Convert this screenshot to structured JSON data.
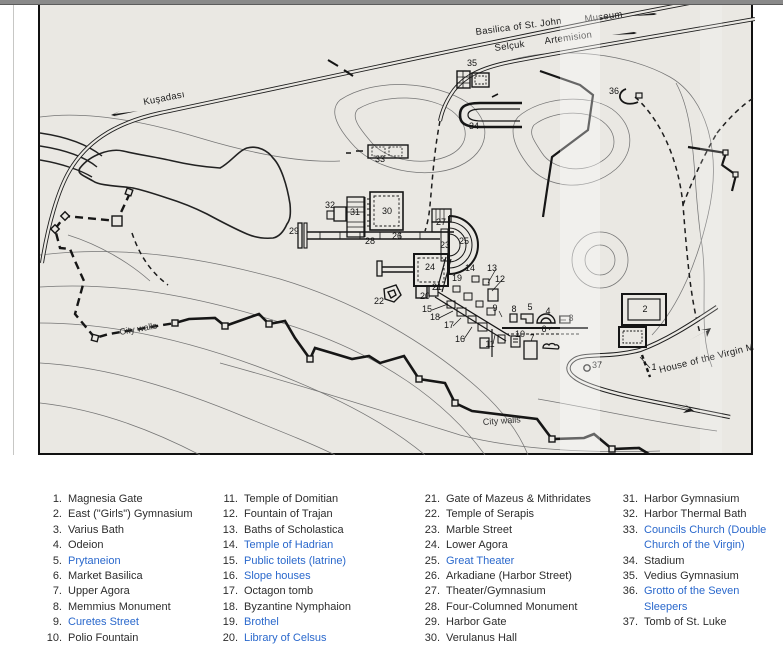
{
  "map": {
    "labels": {
      "basilica": "Basilica of St. John",
      "museum": "Museum",
      "selcuk": "Selçuk",
      "artemision": "Artemision",
      "kusadasi": "Kuşadası",
      "city_walls_west": "City walls",
      "city_walls_south": "City walls",
      "virgin_road": "House of the Virgin M"
    },
    "markers": [
      {
        "n": "1",
        "x": 614,
        "y": 365
      },
      {
        "n": "2",
        "x": 605,
        "y": 307
      },
      {
        "n": "3",
        "x": 531,
        "y": 316
      },
      {
        "n": "4",
        "x": 508,
        "y": 309
      },
      {
        "n": "5",
        "x": 490,
        "y": 305
      },
      {
        "n": "6",
        "x": 504,
        "y": 327
      },
      {
        "n": "7",
        "x": 492,
        "y": 336
      },
      {
        "n": "8",
        "x": 474,
        "y": 307
      },
      {
        "n": "9",
        "x": 455,
        "y": 306
      },
      {
        "n": "10",
        "x": 480,
        "y": 332
      },
      {
        "n": "11",
        "x": 450,
        "y": 342
      },
      {
        "n": "12",
        "x": 460,
        "y": 277
      },
      {
        "n": "13",
        "x": 452,
        "y": 266
      },
      {
        "n": "14",
        "x": 430,
        "y": 266
      },
      {
        "n": "15",
        "x": 387,
        "y": 307
      },
      {
        "n": "16",
        "x": 420,
        "y": 337
      },
      {
        "n": "17",
        "x": 409,
        "y": 323
      },
      {
        "n": "18",
        "x": 395,
        "y": 315
      },
      {
        "n": "19",
        "x": 417,
        "y": 276
      },
      {
        "n": "20",
        "x": 385,
        "y": 294
      },
      {
        "n": "21",
        "x": 397,
        "y": 285
      },
      {
        "n": "22",
        "x": 339,
        "y": 299
      },
      {
        "n": "23",
        "x": 405,
        "y": 243
      },
      {
        "n": "24",
        "x": 390,
        "y": 265
      },
      {
        "n": "25",
        "x": 424,
        "y": 239
      },
      {
        "n": "26",
        "x": 357,
        "y": 234
      },
      {
        "n": "27",
        "x": 401,
        "y": 220
      },
      {
        "n": "28",
        "x": 330,
        "y": 239
      },
      {
        "n": "29",
        "x": 254,
        "y": 229
      },
      {
        "n": "30",
        "x": 347,
        "y": 209
      },
      {
        "n": "31",
        "x": 315,
        "y": 210
      },
      {
        "n": "32",
        "x": 290,
        "y": 203
      },
      {
        "n": "33",
        "x": 340,
        "y": 157
      },
      {
        "n": "34",
        "x": 434,
        "y": 124
      },
      {
        "n": "35",
        "x": 432,
        "y": 61
      },
      {
        "n": "36",
        "x": 574,
        "y": 89
      },
      {
        "n": "37",
        "x": 557,
        "y": 363
      }
    ]
  },
  "legend": {
    "columns": [
      {
        "items": [
          {
            "num": "1.",
            "label": "Magnesia Gate",
            "link": false
          },
          {
            "num": "2.",
            "label": "East (\"Girls\") Gymnasium",
            "link": false
          },
          {
            "num": "3.",
            "label": "Varius Bath",
            "link": false
          },
          {
            "num": "4.",
            "label": "Odeion",
            "link": false
          },
          {
            "num": "5.",
            "label": "Prytaneion",
            "link": true
          },
          {
            "num": "6.",
            "label": "Market Basilica",
            "link": false
          },
          {
            "num": "7.",
            "label": "Upper Agora",
            "link": false
          },
          {
            "num": "8.",
            "label": "Memmius Monument",
            "link": false
          },
          {
            "num": "9.",
            "label": "Curetes Street",
            "link": true
          },
          {
            "num": "10.",
            "label": "Polio Fountain",
            "link": false
          }
        ]
      },
      {
        "items": [
          {
            "num": "11.",
            "label": "Temple of Domitian",
            "link": false
          },
          {
            "num": "12.",
            "label": "Fountain of Trajan",
            "link": false
          },
          {
            "num": "13.",
            "label": "Baths of Scholastica",
            "link": false
          },
          {
            "num": "14.",
            "label": "Temple of Hadrian",
            "link": true
          },
          {
            "num": "15.",
            "label": "Public toilets (latrine)",
            "link": true
          },
          {
            "num": "16.",
            "label": "Slope houses",
            "link": true
          },
          {
            "num": "17.",
            "label": "Octagon tomb",
            "link": false
          },
          {
            "num": "18.",
            "label": "Byzantine Nymphaion",
            "link": false
          },
          {
            "num": "19.",
            "label": "Brothel",
            "link": true
          },
          {
            "num": "20.",
            "label": "Library of Celsus",
            "link": true
          }
        ]
      },
      {
        "items": [
          {
            "num": "21.",
            "label": "Gate of Mazeus & Mithridates",
            "link": false
          },
          {
            "num": "22.",
            "label": "Temple of Serapis",
            "link": false
          },
          {
            "num": "23.",
            "label": "Marble Street",
            "link": false
          },
          {
            "num": "24.",
            "label": "Lower Agora",
            "link": false
          },
          {
            "num": "25.",
            "label": "Great Theater",
            "link": true
          },
          {
            "num": "26.",
            "label": "Arkadiane (Harbor Street)",
            "link": false
          },
          {
            "num": "27.",
            "label": "Theater/Gymnasium",
            "link": false
          },
          {
            "num": "28.",
            "label": "Four-Columned Monument",
            "link": false
          },
          {
            "num": "29.",
            "label": "Harbor Gate",
            "link": false
          },
          {
            "num": "30.",
            "label": "Verulanus Hall",
            "link": false
          }
        ]
      },
      {
        "items": [
          {
            "num": "31.",
            "label": "Harbor Gymnasium",
            "link": false
          },
          {
            "num": "32.",
            "label": "Harbor Thermal Bath",
            "link": false
          },
          {
            "num": "33.",
            "label": "Councils Church (Double Church of the Virgin)",
            "link": true
          },
          {
            "num": "34.",
            "label": "Stadium",
            "link": false
          },
          {
            "num": "35.",
            "label": "Vedius Gymnasium",
            "link": false
          },
          {
            "num": "36.",
            "label": "Grotto of the Seven Sleepers",
            "link": true
          },
          {
            "num": "37.",
            "label": "Tomb of St. Luke",
            "link": false
          }
        ]
      }
    ]
  },
  "colors": {
    "map_background": "#eae8e3",
    "ink": "#1d1d1d",
    "contour": "#757575",
    "link_blue": "#2a68cc",
    "topbar_gray": "#8a8a8a"
  }
}
